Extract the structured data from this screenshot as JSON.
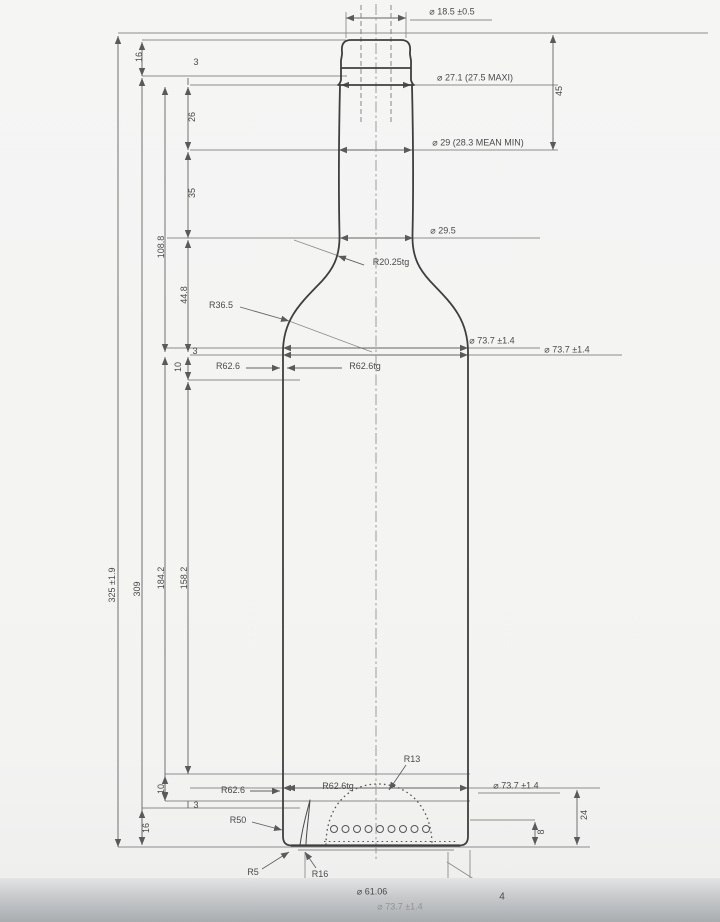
{
  "drawing": {
    "balloon_number": "4",
    "diameters": {
      "bore": "⌀ 18.5 ±0.5",
      "finish_od": "⌀ 27.1 (27.5 MAXI)",
      "neck_upper": "⌀ 29 (28.3 MEAN MIN)",
      "neck_lower": "⌀ 29.5",
      "body_upper": "⌀ 73.7 ±1.4",
      "body_upper_alt": "⌀ 73.7 ±1.4",
      "body_lower": "⌀ 73.7 ±1.4",
      "body_lower_faint": "⌀ 73.7 ±1.4",
      "base_bearing": "⌀ 61.06"
    },
    "radii": {
      "neck_taper": "R20.25tg",
      "shoulder": "R36.5",
      "shoulder_flank": "R62.6",
      "shoulder_flank_tangent": "R62.6tg",
      "heel_flank": "R62.6",
      "heel_flank_tangent": "R62.6tg",
      "heel_inner": "R50",
      "punt_dome": "R13",
      "heel_outer": "R5",
      "punt_base": "R16"
    },
    "heights": {
      "finish": "16",
      "finish_undercut": "3",
      "neck_upper": "26",
      "neck_mid": "35",
      "neck_total": "108.8",
      "shoulder": "44.8",
      "shoulder_step": "3",
      "shoulder_offset": "10",
      "overall": "325 ±1.9",
      "body_height": "309",
      "section_upper": "184.2",
      "section_lower": "158.2",
      "finish_to_neck": "45",
      "heel_offset": "10",
      "heel_step": "3",
      "heel_band": "16",
      "punt_height": "24",
      "stipple_height": "8"
    }
  }
}
